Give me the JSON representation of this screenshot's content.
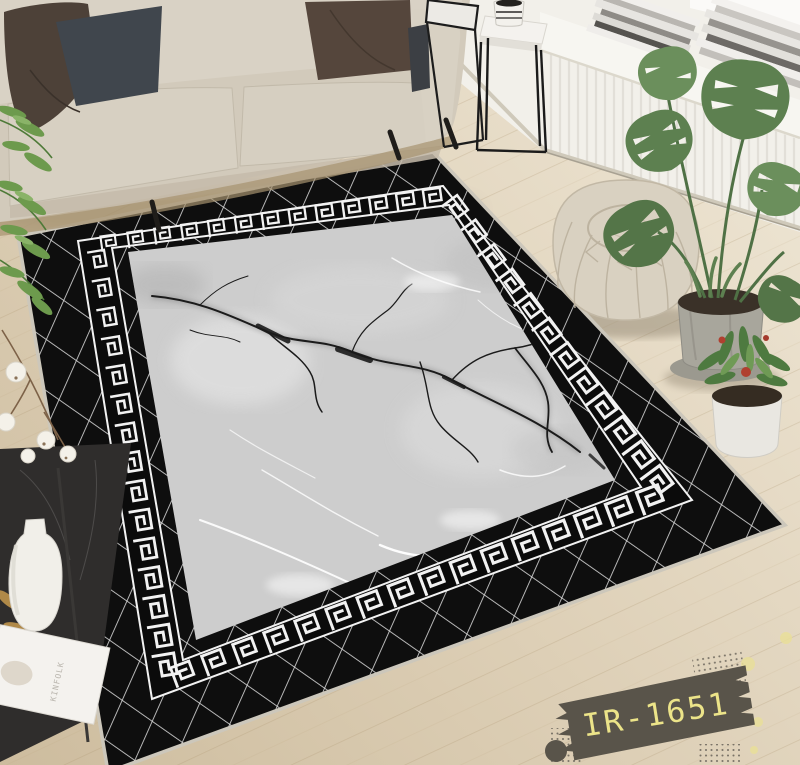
{
  "product_label": {
    "code": "IR-1651",
    "ribbon_color": "#59544a",
    "text_color": "#ece489"
  },
  "magazine": {
    "title": "KINFOLK"
  },
  "palette": {
    "rug_black": "#0e0e0e",
    "rug_lattice_silver": "#d2d2d2",
    "greek_key_white": "#f2f2f2",
    "marble_gray": "#cdcdcd",
    "floor_wood_light": "#eae0cb",
    "floor_wood_dark": "#d2c2a6",
    "wall_white": "#f2f0ea",
    "sofa_beige": "#d2cabb",
    "pouf_beige": "#d9d1c1",
    "plant_green": "#5d8050",
    "ribbon_gray": "#59544a",
    "label_cream": "#ece489"
  }
}
